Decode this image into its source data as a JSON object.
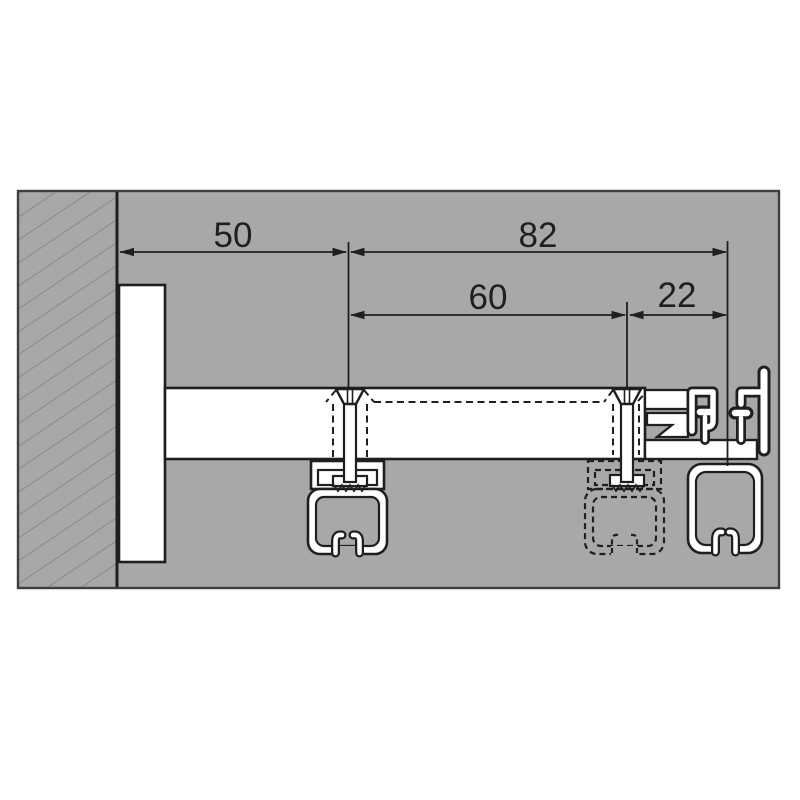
{
  "figure": {
    "type": "technical-cross-section-drawing",
    "description": "Wall-mounted curtain rail support arm, section view",
    "dimension_labels": {
      "wall_to_first_screw": "50",
      "first_screw_to_end_profile": "82",
      "first_to_second_screw": "60",
      "second_screw_to_end_profile": "22"
    },
    "parts": [
      "hatched-wall",
      "wall-bracket-plate",
      "support-arm",
      "front-screw-with-track",
      "hidden-middle-track-dashed",
      "middle-screw",
      "end-adapter-profile",
      "end-carrier-channel"
    ],
    "colors": {
      "page_background": "#ffffff",
      "panel_gray": "#a8a8a8",
      "panel_border": "#3f3f3f",
      "hatch_gray": "#7e7e7e",
      "line_black": "#1f1f1f",
      "profile_fill": "#ffffff"
    }
  }
}
